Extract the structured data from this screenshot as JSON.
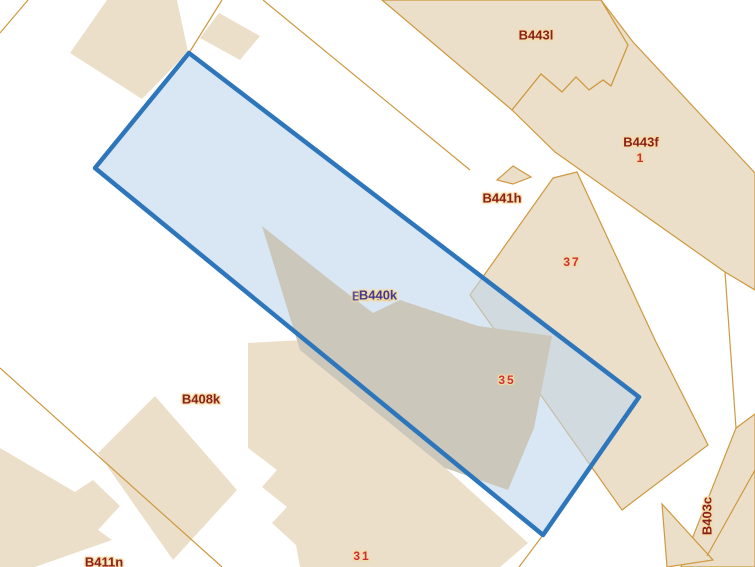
{
  "map": {
    "colors": {
      "bg": "#FFFFFF",
      "parcel_fill": "#EBDFC9",
      "parcel_border": "#CE9940",
      "building_gray": "#CBC7BB",
      "sel_stroke": "#2E76BC",
      "sel_fill": "rgba(192,215,237,0.6)",
      "label_maroon": "#8A1F1F",
      "label_red": "#C9303C",
      "label_navy": "#433A8F",
      "halo": "#F5DAA0"
    },
    "selected_parcel": {
      "label": "B440k",
      "vertices": [
        [
          189,
          53
        ],
        [
          639,
          397
        ],
        [
          543,
          535
        ],
        [
          95,
          168
        ]
      ]
    },
    "labels": [
      {
        "id": "B443l",
        "text": "B443l",
        "x": 536,
        "y": 35,
        "kind": "parcel"
      },
      {
        "id": "B443f",
        "text": "B443f",
        "x": 641,
        "y": 142,
        "kind": "parcel"
      },
      {
        "id": "1",
        "text": "1",
        "x": 641,
        "y": 158,
        "kind": "number"
      },
      {
        "id": "B441h",
        "text": "B441h",
        "x": 502,
        "y": 198,
        "kind": "parcel"
      },
      {
        "id": "37",
        "text": "37",
        "x": 572,
        "y": 262,
        "kind": "number"
      },
      {
        "id": "B440k",
        "text": "B440k",
        "x": 378,
        "y": 295,
        "kind": "selected",
        "ghost": true,
        "ghost_dx": -7,
        "ghost_dy": 1
      },
      {
        "id": "35",
        "text": "35",
        "x": 507,
        "y": 380,
        "kind": "number"
      },
      {
        "id": "B408k",
        "text": "B408k",
        "x": 201,
        "y": 399,
        "kind": "parcel"
      },
      {
        "id": "31",
        "text": "31",
        "x": 362,
        "y": 556,
        "kind": "number"
      },
      {
        "id": "B411n",
        "text": "B411n",
        "x": 104,
        "y": 562,
        "kind": "parcel"
      },
      {
        "id": "B403c",
        "text": "B403c",
        "x": 707,
        "y": 516,
        "kind": "parcel",
        "rotate": -90
      }
    ]
  }
}
